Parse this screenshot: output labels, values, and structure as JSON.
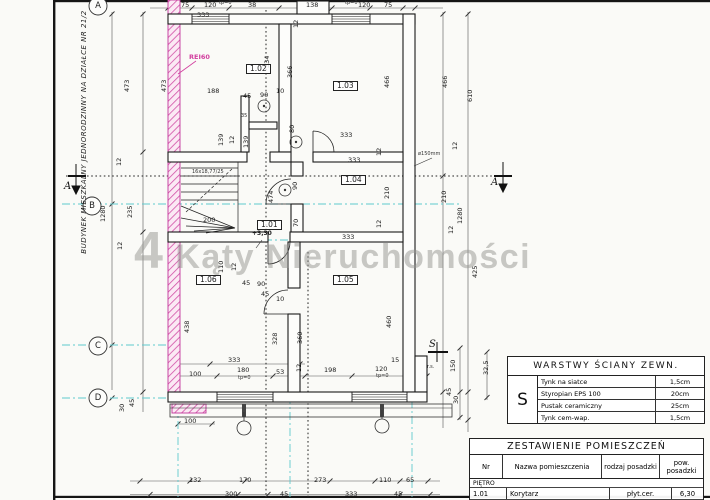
{
  "titles": {
    "watermark": "4 Kąty Nieruchomości",
    "side_text": "BUDYNEK MIESZKALNY JEDNORODZINNY NA DZIAŁCE NR 21/2"
  },
  "grid": [
    "A",
    "B",
    "C",
    "D"
  ],
  "sections": {
    "a_left": "A",
    "a_right": "A",
    "s": "S"
  },
  "colors": {
    "fire_wall": "#d24fa6",
    "axis_cyan": "#5fc9ce",
    "ink": "#1a1a1a",
    "watermark_gray": "#94948f"
  },
  "tables": {
    "wall_layers": {
      "title": "WARSTWY ŚCIANY ZEWN.",
      "symbol": "S",
      "rows": [
        [
          "Tynk na siatce",
          "1,5cm"
        ],
        [
          "Styropian EPS 100",
          "20cm"
        ],
        [
          "Pustak ceramiczny",
          "25cm"
        ],
        [
          "Tynk cem-wap.",
          "1,5cm"
        ]
      ]
    },
    "room_schedule": {
      "title": "ZESTAWIENIE POMIESZCZEŃ",
      "headers": [
        "Nr",
        "Nazwa pomieszczenia",
        "rodzaj posadzki",
        "pow. posadzki"
      ],
      "section": "PIĘTRO",
      "rows": [
        [
          "1.01",
          "Korytarz",
          "płyt.cer.",
          "6,30"
        ],
        [
          "1.02",
          "",
          "",
          "13,74"
        ]
      ]
    }
  },
  "annotations": [
    {
      "t": "75",
      "x": 181,
      "y": 2
    },
    {
      "t": "120",
      "x": 204,
      "y": 2
    },
    {
      "t": "tp=0",
      "x": 219,
      "y": 1,
      "c": "tiny"
    },
    {
      "t": "38",
      "x": 248,
      "y": 2
    },
    {
      "t": "138",
      "x": 306,
      "y": 2
    },
    {
      "t": "tp=0",
      "x": 345,
      "y": 1,
      "c": "tiny"
    },
    {
      "t": "120",
      "x": 358,
      "y": 2
    },
    {
      "t": "75",
      "x": 384,
      "y": 2
    },
    {
      "t": "333",
      "x": 197,
      "y": 12
    },
    {
      "t": "12",
      "x": 293,
      "y": 28,
      "c": "dimv"
    },
    {
      "t": "473",
      "x": 124,
      "y": 92,
      "c": "dimv"
    },
    {
      "t": "473",
      "x": 161,
      "y": 92,
      "c": "dimv"
    },
    {
      "t": "12",
      "x": 116,
      "y": 166,
      "c": "dimv"
    },
    {
      "t": "1280",
      "x": 100,
      "y": 222,
      "c": "dimv"
    },
    {
      "t": "235",
      "x": 127,
      "y": 218,
      "c": "dimv"
    },
    {
      "t": "12",
      "x": 117,
      "y": 250,
      "c": "dimv"
    },
    {
      "t": "438",
      "x": 184,
      "y": 333,
      "c": "dimv"
    },
    {
      "t": "30",
      "x": 119,
      "y": 412,
      "c": "dimv"
    },
    {
      "t": "45",
      "x": 129,
      "y": 407,
      "c": "dimv"
    },
    {
      "t": "466",
      "x": 384,
      "y": 88,
      "c": "dimv"
    },
    {
      "t": "466",
      "x": 442,
      "y": 88,
      "c": "dimv"
    },
    {
      "t": "610",
      "x": 467,
      "y": 102,
      "c": "dimv"
    },
    {
      "t": "12",
      "x": 452,
      "y": 150,
      "c": "dimv"
    },
    {
      "t": "210",
      "x": 441,
      "y": 203,
      "c": "dimv"
    },
    {
      "t": "1280",
      "x": 457,
      "y": 224,
      "c": "dimv"
    },
    {
      "t": "12",
      "x": 448,
      "y": 234,
      "c": "dimv"
    },
    {
      "t": "425",
      "x": 472,
      "y": 278,
      "c": "dimv"
    },
    {
      "t": "150",
      "x": 450,
      "y": 372,
      "c": "dimv"
    },
    {
      "t": "32,5",
      "x": 483,
      "y": 375,
      "c": "dimv"
    },
    {
      "t": "45",
      "x": 446,
      "y": 396,
      "c": "dimv"
    },
    {
      "t": "30",
      "x": 453,
      "y": 404,
      "c": "dimv"
    },
    {
      "t": "r.s.",
      "x": 427,
      "y": 365,
      "c": "tiny"
    },
    {
      "t": "334",
      "x": 264,
      "y": 68,
      "c": "dimv"
    },
    {
      "t": "366",
      "x": 287,
      "y": 78,
      "c": "dimv"
    },
    {
      "t": "188",
      "x": 207,
      "y": 88
    },
    {
      "t": "45",
      "x": 243,
      "y": 93
    },
    {
      "t": "90",
      "x": 260,
      "y": 92
    },
    {
      "t": "10",
      "x": 276,
      "y": 88
    },
    {
      "t": "35",
      "x": 241,
      "y": 114,
      "c": "tiny"
    },
    {
      "t": "80",
      "x": 289,
      "y": 133,
      "c": "dimv"
    },
    {
      "t": "139",
      "x": 218,
      "y": 146,
      "c": "dimv"
    },
    {
      "t": "12",
      "x": 229,
      "y": 144,
      "c": "dimv"
    },
    {
      "t": "139",
      "x": 243,
      "y": 148,
      "c": "dimv"
    },
    {
      "t": "200",
      "x": 203,
      "y": 217
    },
    {
      "t": "110",
      "x": 218,
      "y": 273,
      "c": "dimv"
    },
    {
      "t": "12",
      "x": 231,
      "y": 271,
      "c": "dimv"
    },
    {
      "t": "474",
      "x": 268,
      "y": 203,
      "c": "dimv"
    },
    {
      "t": "90",
      "x": 292,
      "y": 190,
      "c": "dimv"
    },
    {
      "t": "70",
      "x": 293,
      "y": 227,
      "c": "dimv"
    },
    {
      "t": "333",
      "x": 340,
      "y": 132
    },
    {
      "t": "12",
      "x": 376,
      "y": 156,
      "c": "dimv"
    },
    {
      "t": "333",
      "x": 348,
      "y": 157
    },
    {
      "t": "210",
      "x": 384,
      "y": 199,
      "c": "dimv"
    },
    {
      "t": "12",
      "x": 376,
      "y": 228,
      "c": "dimv"
    },
    {
      "t": "333",
      "x": 342,
      "y": 234
    },
    {
      "t": "ø150mm",
      "x": 418,
      "y": 152,
      "c": "tiny",
      "n": "pipe-label"
    },
    {
      "t": "45",
      "x": 242,
      "y": 280
    },
    {
      "t": "90",
      "x": 257,
      "y": 281
    },
    {
      "t": "45",
      "x": 261,
      "y": 291
    },
    {
      "t": "10",
      "x": 276,
      "y": 296
    },
    {
      "t": "328",
      "x": 272,
      "y": 345,
      "c": "dimv"
    },
    {
      "t": "360",
      "x": 297,
      "y": 344,
      "c": "dimv"
    },
    {
      "t": "460",
      "x": 386,
      "y": 328,
      "c": "dimv"
    },
    {
      "t": "333",
      "x": 228,
      "y": 357
    },
    {
      "t": "100",
      "x": 189,
      "y": 371
    },
    {
      "t": "180",
      "x": 237,
      "y": 367
    },
    {
      "t": "tp=0",
      "x": 238,
      "y": 376,
      "c": "tiny"
    },
    {
      "t": "53",
      "x": 276,
      "y": 369
    },
    {
      "t": "12",
      "x": 296,
      "y": 372,
      "c": "dimv"
    },
    {
      "t": "198",
      "x": 324,
      "y": 367
    },
    {
      "t": "120",
      "x": 375,
      "y": 366
    },
    {
      "t": "tp=0",
      "x": 376,
      "y": 374,
      "c": "tiny"
    },
    {
      "t": "15",
      "x": 391,
      "y": 357
    },
    {
      "t": "100",
      "x": 184,
      "y": 418
    },
    {
      "t": "132",
      "x": 189,
      "y": 477
    },
    {
      "t": "170",
      "x": 239,
      "y": 477
    },
    {
      "t": "273",
      "x": 314,
      "y": 477
    },
    {
      "t": "110",
      "x": 379,
      "y": 477
    },
    {
      "t": "65",
      "x": 406,
      "y": 477
    },
    {
      "t": "300",
      "x": 225,
      "y": 491
    },
    {
      "t": "45",
      "x": 280,
      "y": 491
    },
    {
      "t": "333",
      "x": 345,
      "y": 491
    },
    {
      "t": "45",
      "x": 394,
      "y": 491
    },
    {
      "t": "REI60",
      "x": 189,
      "y": 54,
      "c": "rei",
      "n": "fire-rating-label"
    },
    {
      "t": "16x18,77/25",
      "x": 192,
      "y": 170,
      "c": "tiny",
      "n": "stair-note"
    },
    {
      "t": "+3,30",
      "x": 252,
      "y": 231,
      "c": "level",
      "n": "level-marker"
    },
    {
      "t": "1.02",
      "x": 246,
      "y": 64,
      "c": "room",
      "n": "room-label-1-02"
    },
    {
      "t": "1.03",
      "x": 333,
      "y": 81,
      "c": "room",
      "n": "room-label-1-03"
    },
    {
      "t": "1.04",
      "x": 341,
      "y": 175,
      "c": "room",
      "n": "room-label-1-04"
    },
    {
      "t": "1.01",
      "x": 257,
      "y": 220,
      "c": "room",
      "n": "room-label-1-01"
    },
    {
      "t": "1.06",
      "x": 196,
      "y": 275,
      "c": "room",
      "n": "room-label-1-06"
    },
    {
      "t": "1.05",
      "x": 333,
      "y": 275,
      "c": "room",
      "n": "room-label-1-05"
    }
  ]
}
